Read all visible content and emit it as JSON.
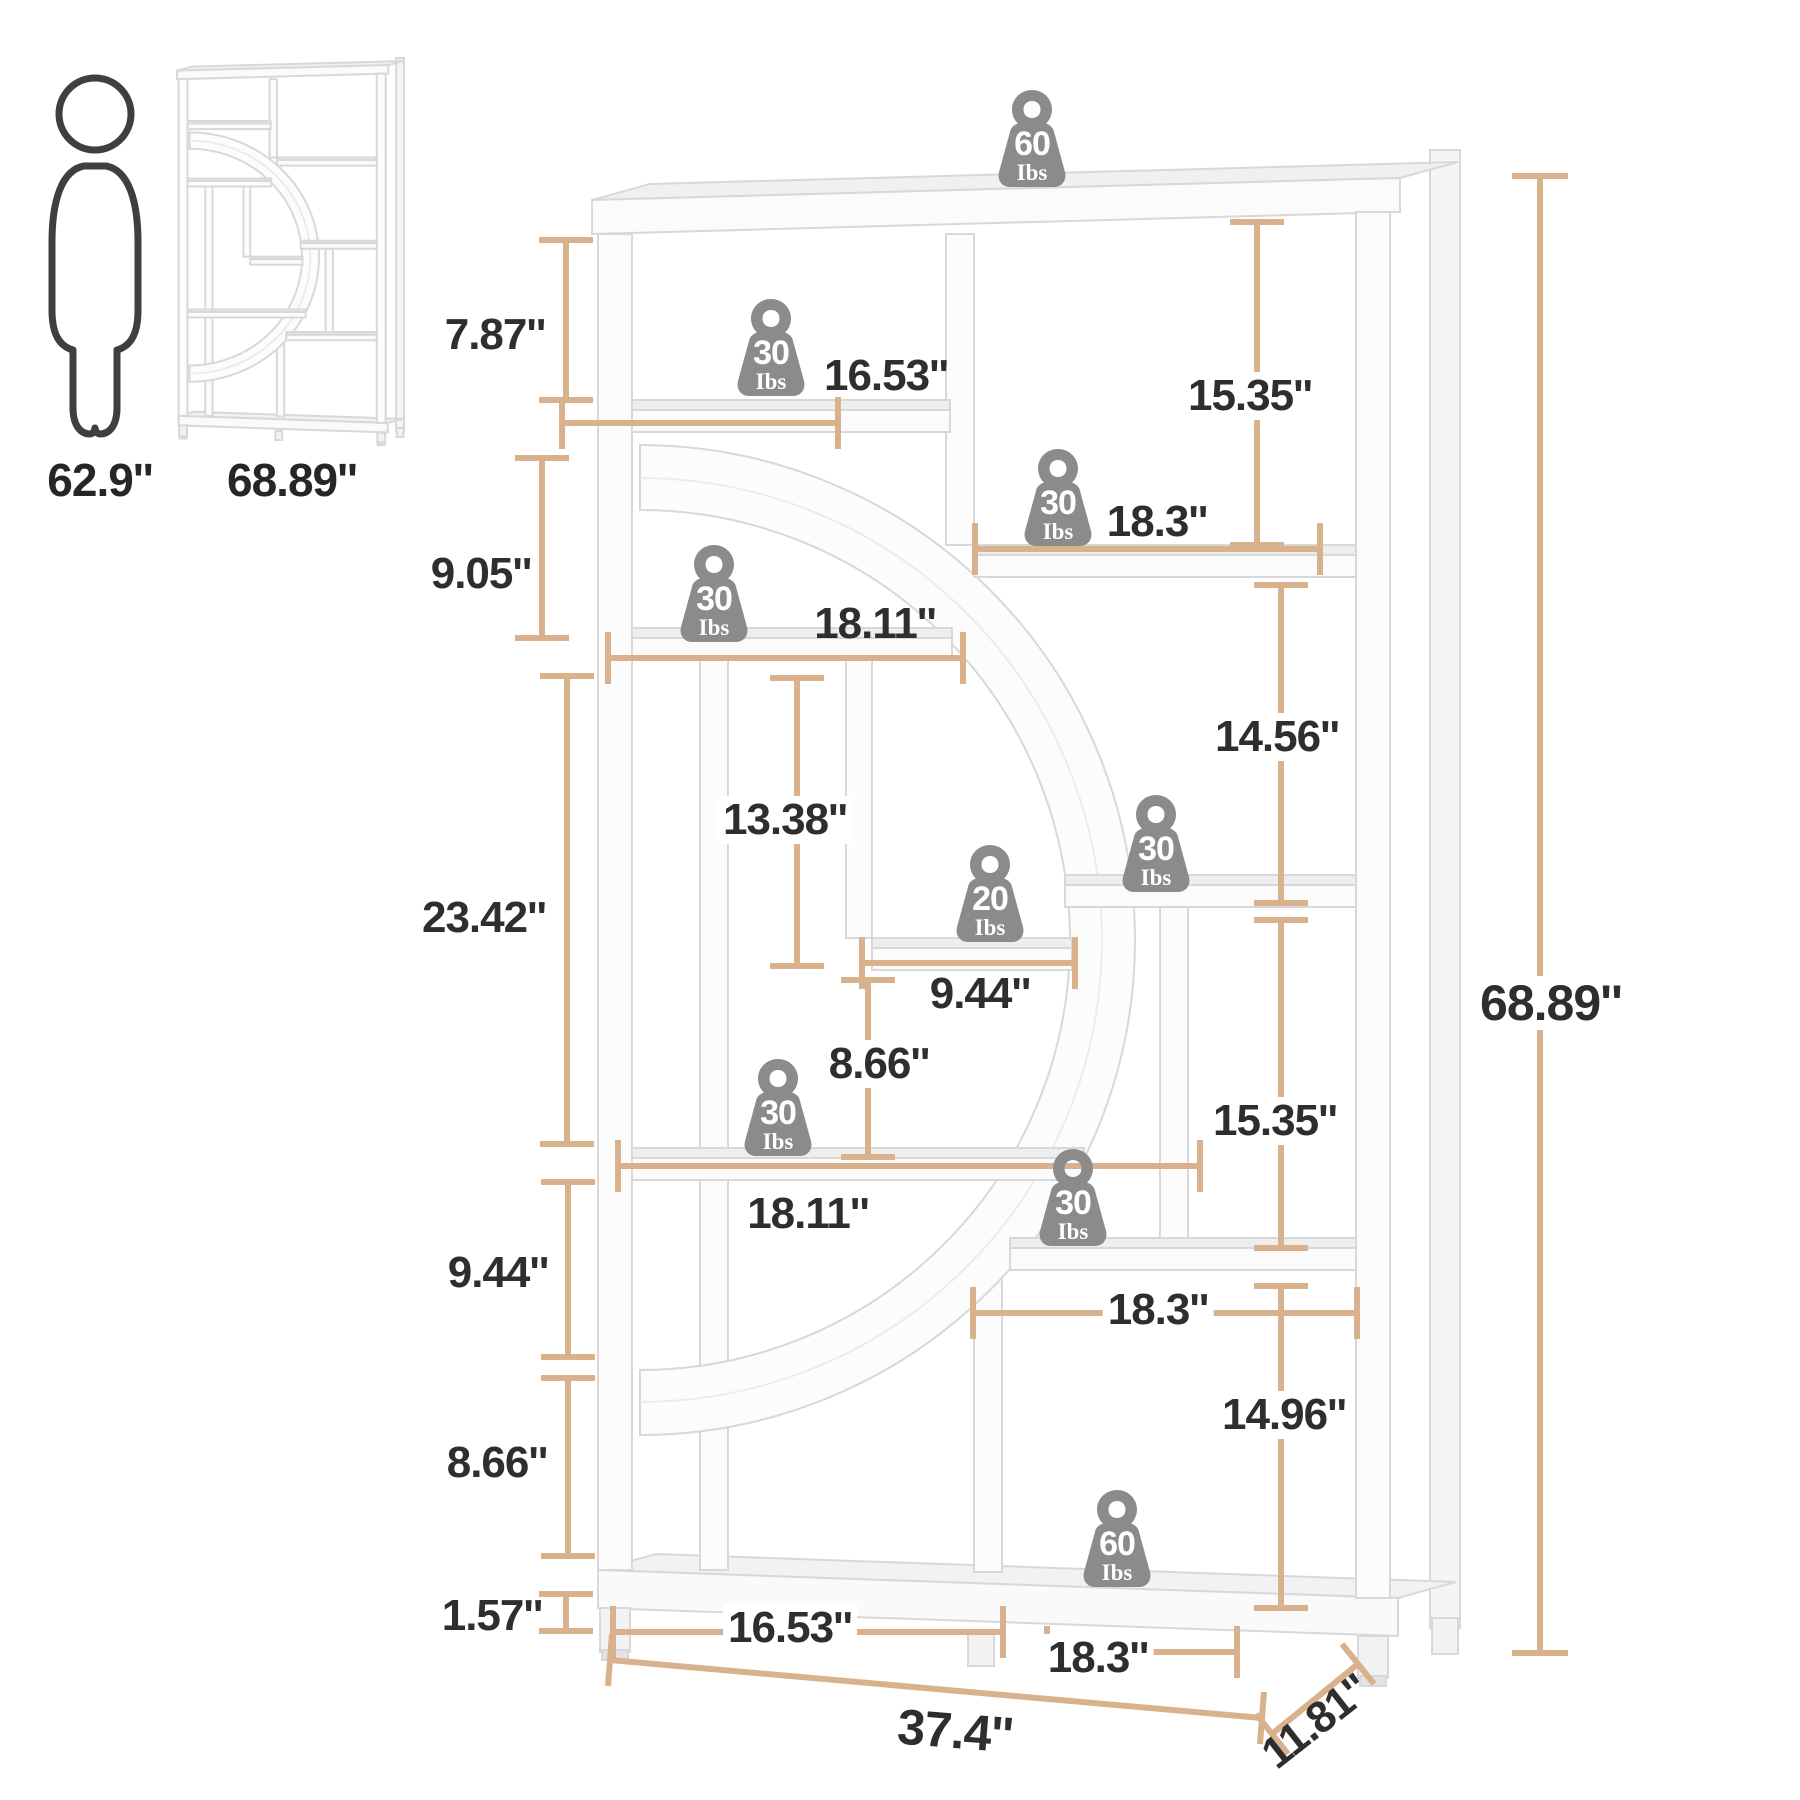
{
  "legend": {
    "person_height": "62.9''",
    "bookcase_height": "68.89''"
  },
  "dimensions": {
    "top_gap": "7.87''",
    "second_gap": "9.05''",
    "left_tall_gap": "23.42''",
    "left_lower_gap": "9.44''",
    "left_lower_gap2": "8.66''",
    "base_height": "1.57''",
    "mid_gap": "13.38''",
    "mid_gap2": "8.66''",
    "shelf_top_width": "16.53''",
    "shelf_right_width": "18.3''",
    "shelf_mid_width": "18.11''",
    "small_shelf_width": "9.44''",
    "shelf_lower_width": "18.11''",
    "shelf_lowerright_width": "18.3''",
    "bottom_left_width": "16.53''",
    "bottom_right_width": "18.3''",
    "right_gap_top": "15.35''",
    "right_gap2": "14.56''",
    "right_gap3": "15.35''",
    "right_gap4": "14.96''",
    "total_height": "68.89''",
    "total_width": "37.4''",
    "total_depth": "11.81''"
  },
  "weights": [
    {
      "value": "60",
      "unit": "Ibs",
      "location": "top-board"
    },
    {
      "value": "30",
      "unit": "Ibs",
      "location": "upper-left-shelf"
    },
    {
      "value": "30",
      "unit": "Ibs",
      "location": "upper-right-shelf"
    },
    {
      "value": "30",
      "unit": "Ibs",
      "location": "mid-left-shelf"
    },
    {
      "value": "20",
      "unit": "Ibs",
      "location": "small-middle-shelf"
    },
    {
      "value": "30",
      "unit": "Ibs",
      "location": "mid-right-shelf"
    },
    {
      "value": "30",
      "unit": "Ibs",
      "location": "lower-left-shelf"
    },
    {
      "value": "30",
      "unit": "Ibs",
      "location": "lower-right-shelf"
    },
    {
      "value": "60",
      "unit": "Ibs",
      "location": "bottom-shelf"
    }
  ],
  "colors": {
    "dimension_line": "#d9b18c",
    "label_text": "#2e2e2e",
    "weight_badge": "#8b8b8b",
    "furniture_stroke": "#d8d8d8"
  }
}
